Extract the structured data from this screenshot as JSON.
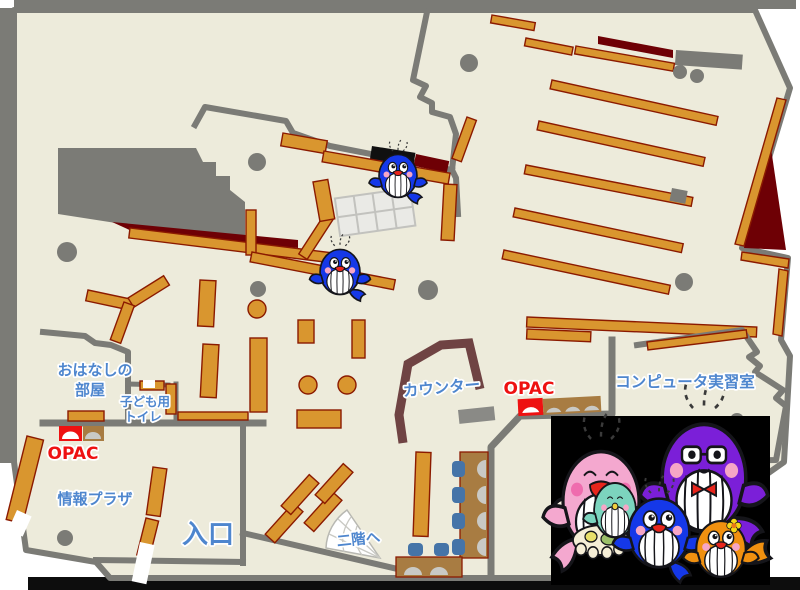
{
  "labels": {
    "storytelling_room_line1": "おはなしの",
    "storytelling_room_line2": "部屋",
    "kids_toilet_line1": "子ども用",
    "kids_toilet_line2": "トイレ",
    "opac_left": "OPAC",
    "opac_right": "OPAC",
    "info_plaza": "情報プラザ",
    "entrance": "入口",
    "counter": "カウンター",
    "stairs_to_2f": "二階へ",
    "computer_room": "コンピュータ実習室"
  },
  "colors": {
    "floor": "#edebdb",
    "wall": "#7b7b76",
    "shelf": "#d9962f",
    "shelf_outline": "#8b1a00",
    "dark_red": "#6e0005",
    "counter_brown": "#6f4343",
    "table_brown": "#a87c42",
    "chair_blue": "#4574a8",
    "monitor_gray": "#c9c9c5",
    "label_blue": "#4e86ce",
    "accent_red": "#ee1111",
    "whale_blue": "#1538e8",
    "whale_pink": "#f4a8cf",
    "whale_purple": "#7b1fd8",
    "whale_orange": "#f09010",
    "whale_teal": "#7cd4be",
    "photo_background": "#000000"
  },
  "mascots": {
    "on_map": [
      "blue-whale-mascot",
      "blue-whale-mascot"
    ],
    "family_photo": [
      "pink-mother-whale",
      "teal-baby-whale",
      "blue-child-whale",
      "purple-father-whale",
      "orange-child-whale"
    ]
  }
}
